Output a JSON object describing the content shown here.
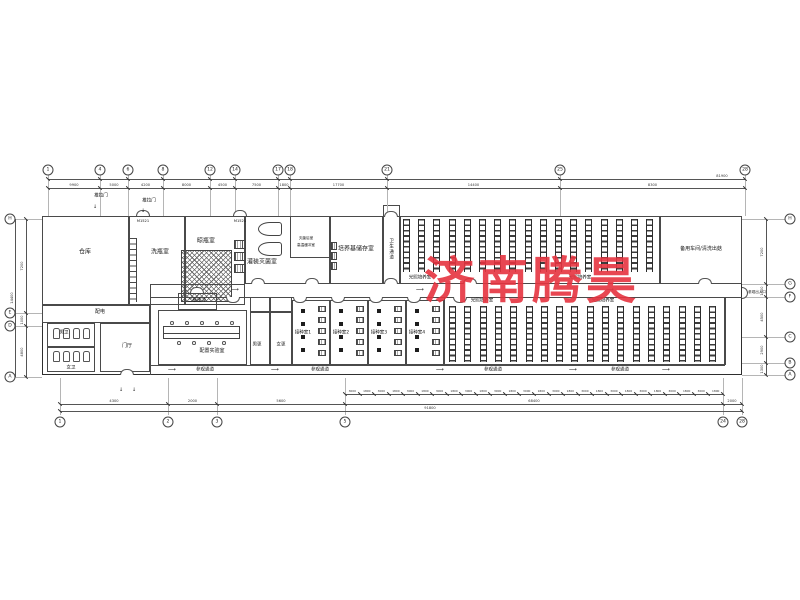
{
  "watermark": {
    "text": "济南腾昊",
    "color": "#e63440"
  },
  "rooms": {
    "warehouse": "仓库",
    "bottle_washing": "洗瓶室",
    "bottle_drying": "晾瓶室",
    "filling_sterilizing": "灌装灭菌室",
    "post_sterilizing": "灭菌后室",
    "high_temp_buffer": "高温缓冲室",
    "medium_storage": "培养基储存室",
    "sanitary_passage": "卫生通道",
    "light_culture": "光照培养室",
    "spare_workshop": "备用车间/清洗出菇",
    "power_room": "配电",
    "mens_toilet": "男卫",
    "womens_toilet": "女卫",
    "lobby": "门厅",
    "secondary_buffer": "二级缓冲",
    "prep_lab": "配置实验室",
    "mens_changing": "男更",
    "womens_changing": "女更",
    "inoculation_1": "接种室1",
    "inoculation_2": "接种室2",
    "inoculation_3": "接种室3",
    "inoculation_4": "接种室4"
  },
  "annotations": {
    "visitor_corridor": "参观通道",
    "visitor_entrance": "参观出入口",
    "sliding_door": "推拉门",
    "door_tag": "M1521"
  },
  "grid": {
    "top_axes": [
      "1",
      "4",
      "6",
      "8",
      "12",
      "14",
      "17",
      "18",
      "21",
      "25",
      "28"
    ],
    "bottom_axes": [
      "1",
      "2",
      "3",
      "5",
      "24",
      "28"
    ],
    "left_axes": [
      "H",
      "E",
      "D",
      "A"
    ],
    "right_axes": [
      "H",
      "G",
      "F",
      "C",
      "B",
      "A"
    ]
  },
  "dims": {
    "top": [
      "9900",
      "5000",
      "4200",
      "8000",
      "4500",
      "7500",
      "1800",
      "17700",
      "14400",
      "8300"
    ],
    "top_overall": "81900",
    "bottom_left": [
      "4300",
      "2000",
      "5600"
    ],
    "bottom_detail_pair": [
      "3000",
      "1800"
    ],
    "bottom_mid": "68400",
    "bottom_right": "2000",
    "bottom_overall": "91800",
    "left": [
      "7200",
      "1000",
      "4800"
    ],
    "left_overall": "14400",
    "right": [
      "7200",
      "1500",
      "4500",
      "2900",
      "1300"
    ]
  }
}
